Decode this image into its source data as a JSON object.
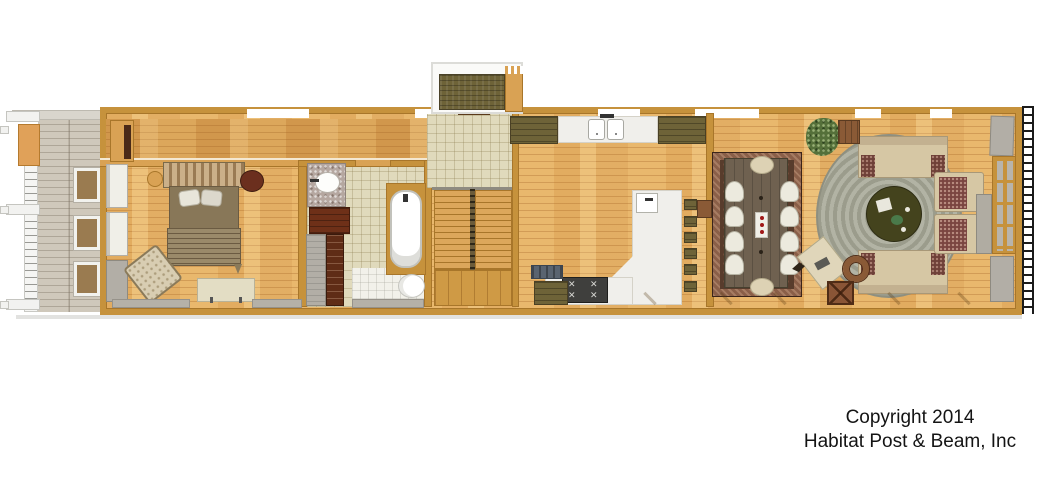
{
  "copyright": {
    "line1": "Copyright 2014",
    "line2": "Habitat Post & Beam, Inc"
  },
  "palette": {
    "background": "#ffffff",
    "wood_frame": "#c6923c",
    "oak_floor": "#e9b86d",
    "deck_gray": "#cfc8bb",
    "tile_tan": "#e0dabc",
    "cabinet_olive": "#6e6338",
    "counter_white": "#f0efeb",
    "vanity_wood_dark": "#6e3018",
    "dining_rug_field": "#583c2c",
    "dining_rug_border": "#8a5f48",
    "living_rug_gray_green": "#a6a797",
    "sofa_tan": "#d6c7a4",
    "cushion_maroon": "#6e4038",
    "text_black": "#141414"
  },
  "plan": {
    "type": "single-story floor plan rendering",
    "rooms": [
      "porch-deck",
      "bedroom",
      "bathroom",
      "closet",
      "entry",
      "stairs",
      "kitchen",
      "dining-room",
      "living-room",
      "entry-stoop",
      "exterior-stair-rail"
    ],
    "elements": [
      "porch-railing",
      "porch-posts",
      "door-mats",
      "dresser",
      "bed",
      "pillows",
      "nightstands",
      "bedroom-armchair",
      "bedroom-bench",
      "vanity-sink",
      "vanity-cabinet",
      "bathtub",
      "toilet",
      "closet-shelves",
      "stair-flights",
      "stair-landing",
      "upper-cabinets",
      "kitchen-sink",
      "kitchen-island",
      "island-prep-sink",
      "stove",
      "bar-stools",
      "dining-rug",
      "dining-table",
      "dining-chairs",
      "candle-tray",
      "living-area-rug",
      "round-coffee-table",
      "sofas",
      "armchairs",
      "console-table",
      "potted-plant",
      "writing-table",
      "ottoman",
      "end-table",
      "french-window",
      "wall-panels",
      "exterior-ladder-rail"
    ]
  }
}
